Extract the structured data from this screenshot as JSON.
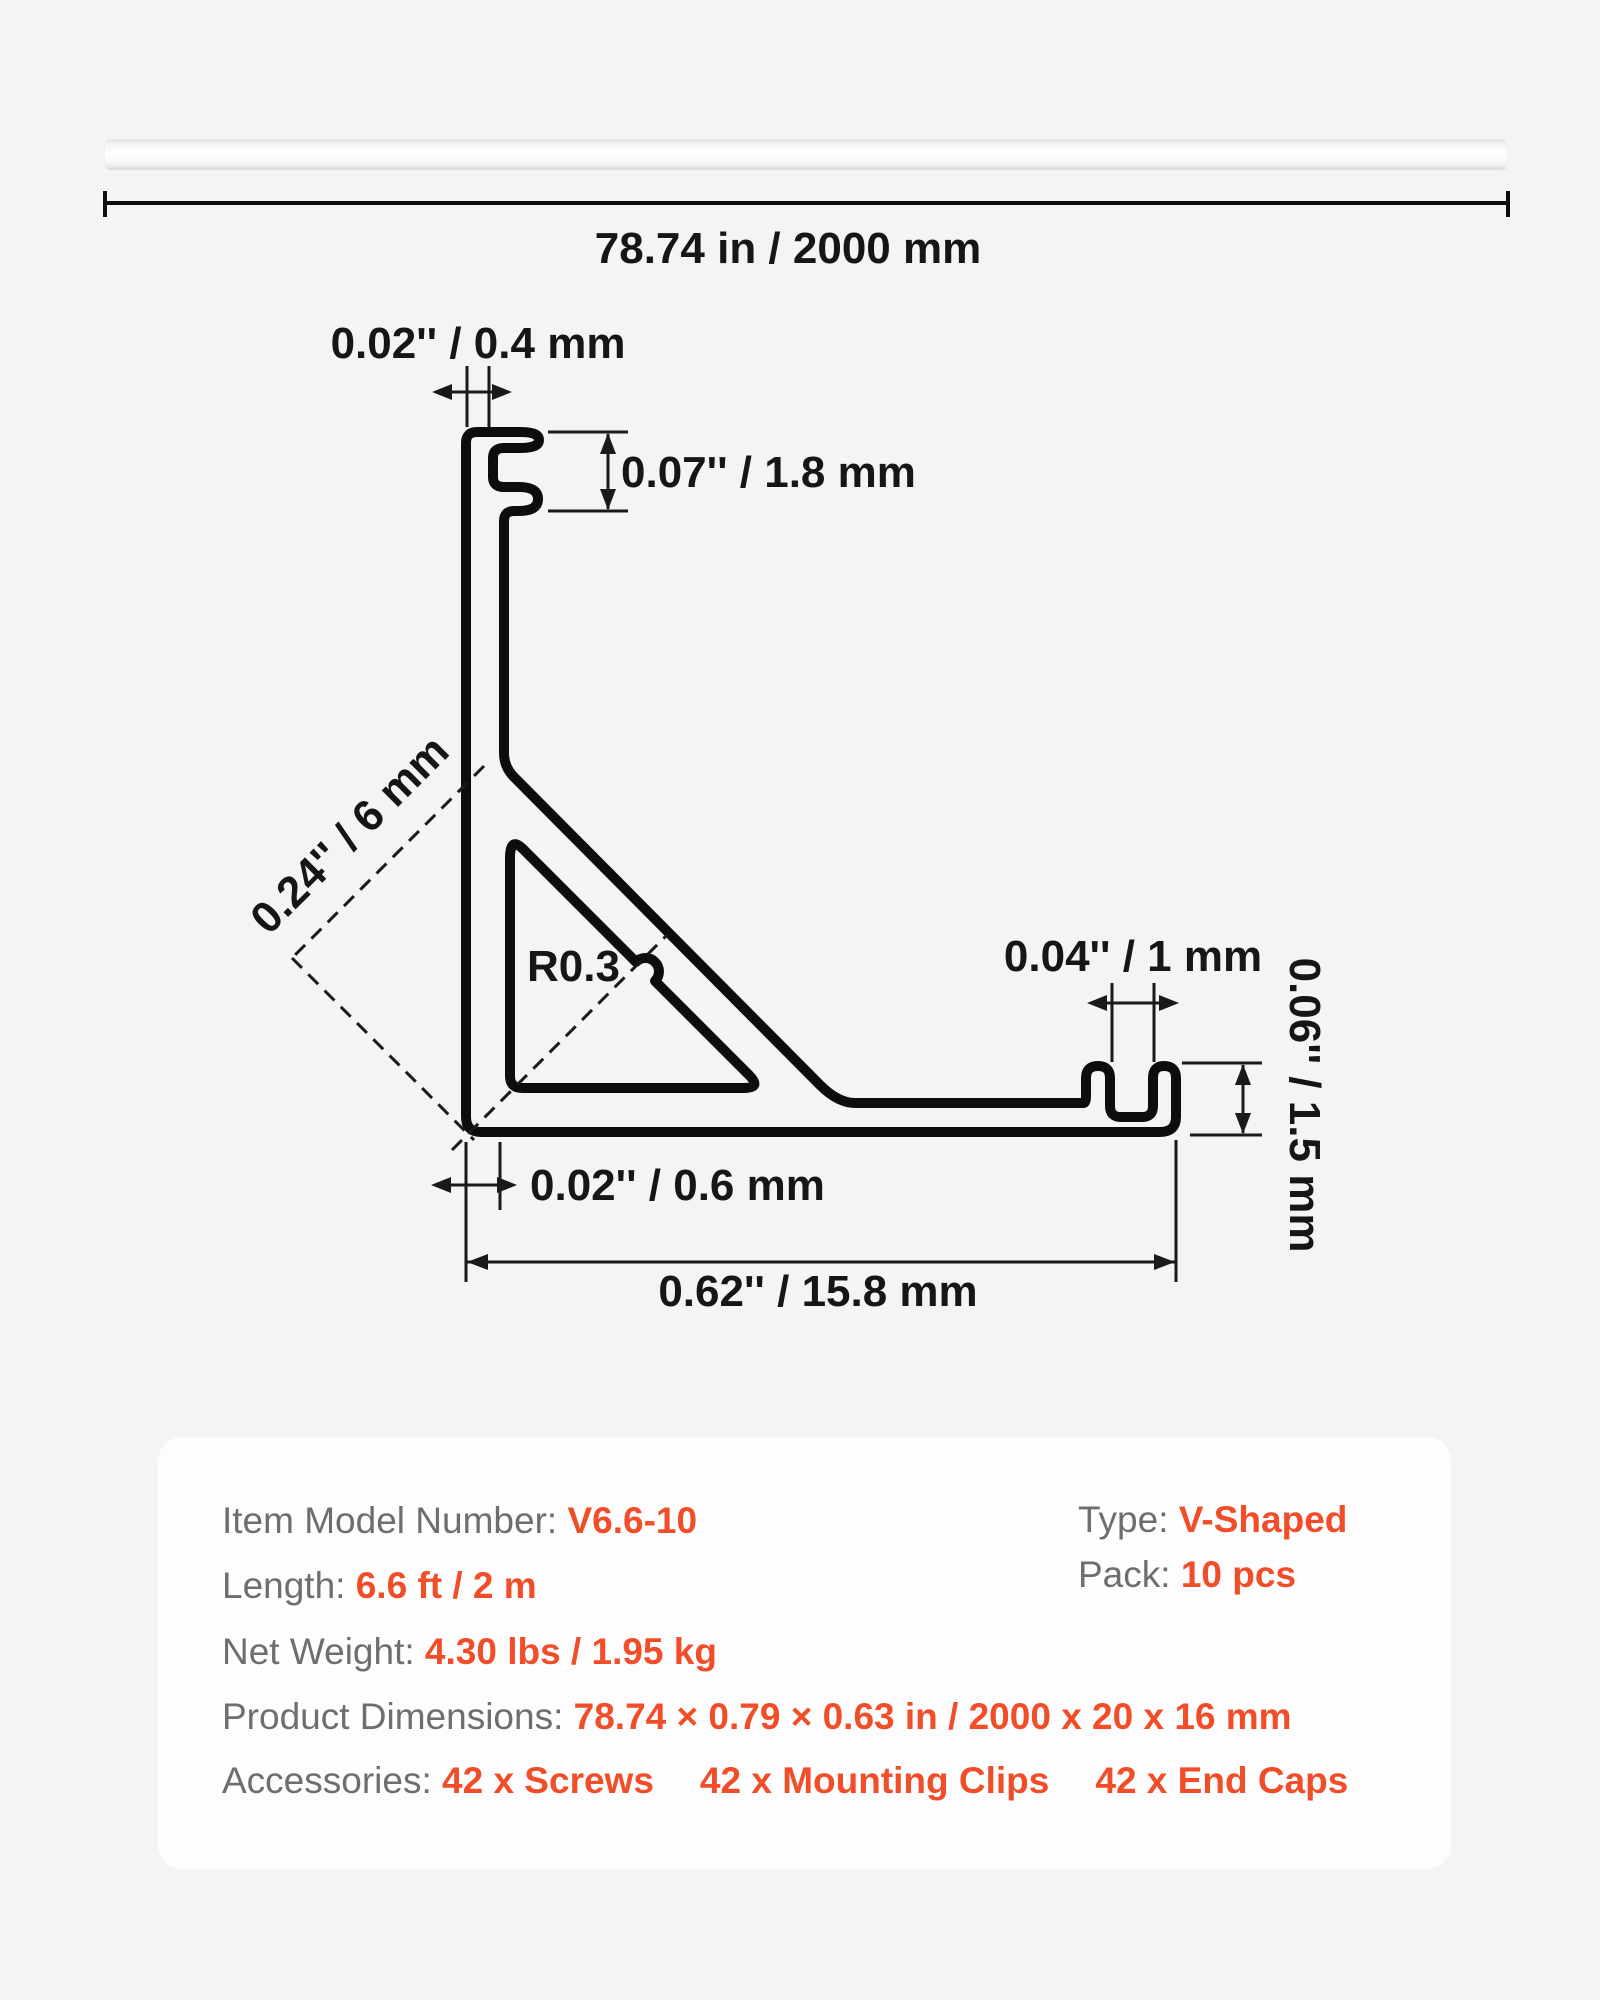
{
  "colors": {
    "page_bg": "#f5f4f2",
    "panel_bg": "#fdfdfd",
    "accent_orange": "#f24d29",
    "label_gray": "#6e6e6e",
    "line_black": "#0d0d0d"
  },
  "hero": {
    "description": "aluminum-channel-profile-bar"
  },
  "dimensions": {
    "overall_length": "78.74 in / 2000 mm",
    "wall_top_thickness": "0.02'' / 0.4 mm",
    "clip_slot_height": "0.07'' / 1.8 mm",
    "groove_diagonal": "0.24'' / 6 mm",
    "corner_radius": "R0.3",
    "end_slot_width": "0.04'' / 1 mm",
    "end_lip_height": "0.06'' / 1.5 mm",
    "wall_bottom_thickness": "0.02'' / 0.6 mm",
    "base_width": "0.62'' / 15.8 mm"
  },
  "specs": {
    "rows": [
      {
        "label": "Item Model Number: ",
        "value": "V6.6-10"
      },
      {
        "label": "Length: ",
        "value": "6.6 ft / 2 m"
      },
      {
        "label": "Net Weight: ",
        "value": "4.30 lbs / 1.95 kg"
      },
      {
        "label": "Product Dimensions: ",
        "value": "78.74 × 0.79 × 0.63 in / 2000 x 20 x 16 mm"
      }
    ],
    "accessories": {
      "label": "Accessories: ",
      "items": [
        "42 x Screws",
        "42 x Mounting Clips",
        "42 x End Caps"
      ]
    },
    "side": [
      {
        "label": "Type: ",
        "value": "V-Shaped"
      },
      {
        "label": "Pack: ",
        "value": "10 pcs"
      }
    ]
  }
}
